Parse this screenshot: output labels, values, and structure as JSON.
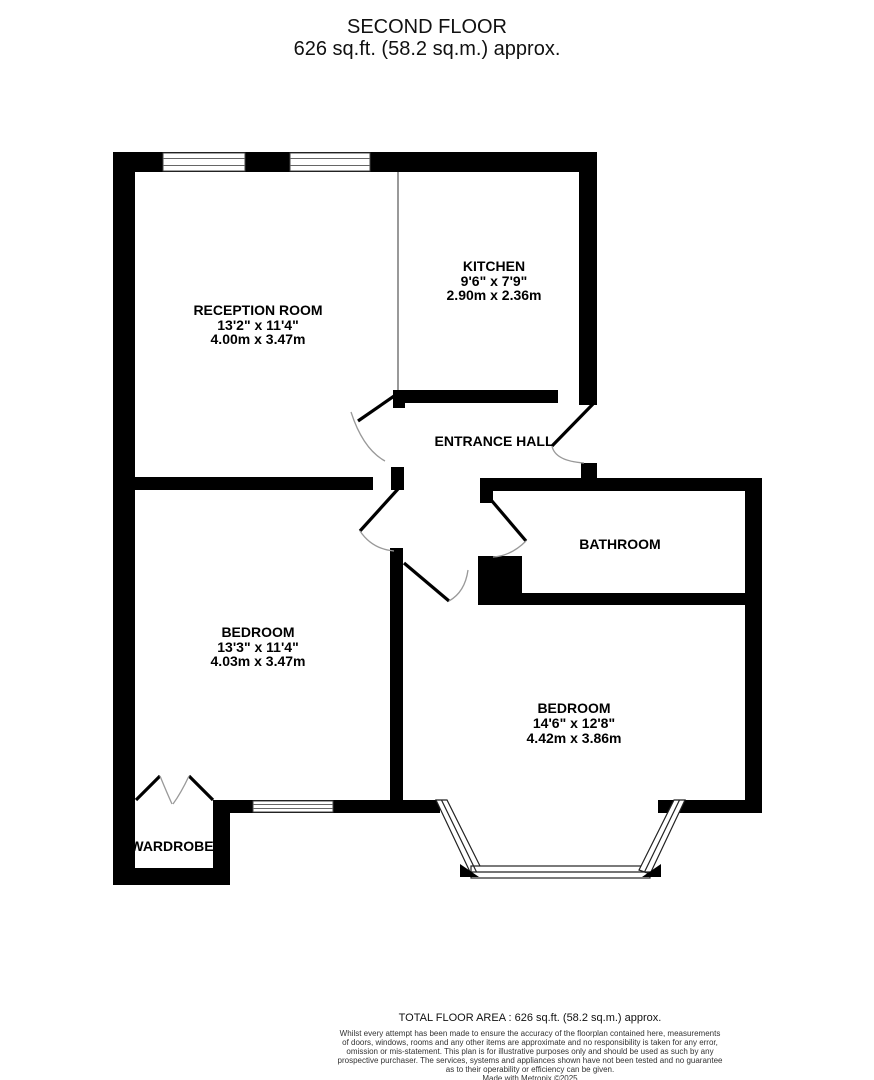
{
  "title": {
    "floor": "SECOND FLOOR",
    "area": "626 sq.ft. (58.2 sq.m.) approx."
  },
  "rooms": {
    "reception": {
      "name": "RECEPTION ROOM",
      "dims_ft": "13'2\" x 11'4\"",
      "dims_m": "4.00m x 3.47m"
    },
    "kitchen": {
      "name": "KITCHEN",
      "dims_ft": "9'6\" x 7'9\"",
      "dims_m": "2.90m x 2.36m"
    },
    "entrance_hall": {
      "name": "ENTRANCE HALL"
    },
    "bathroom": {
      "name": "BATHROOM"
    },
    "bedroom_front": {
      "name": "BEDROOM",
      "dims_ft": "13'3\" x 11'4\"",
      "dims_m": "4.03m x 3.47m"
    },
    "bedroom_rear": {
      "name": "BEDROOM",
      "dims_ft": "14'6\" x 12'8\"",
      "dims_m": "4.42m x 3.86m"
    },
    "wardrobe": {
      "name": "WARDROBE"
    }
  },
  "footer": {
    "total_area": "TOTAL FLOOR AREA : 626 sq.ft. (58.2 sq.m.) approx.",
    "disclaimer_lines": [
      "Whilst every attempt has been made to ensure the accuracy of the floorplan contained here, measurements",
      "of doors, windows, rooms and any other items are approximate and no responsibility is taken for any error,",
      "omission or mis-statement. This plan is for illustrative purposes only and should be used as such by any",
      "prospective purchaser. The services, systems and appliances shown have not been tested and no guarantee",
      "as to their operability or efficiency can be given."
    ],
    "credit": "Made with Metropix ©2025"
  },
  "colors": {
    "wall": "#000000",
    "door_arc": "#999999",
    "window_line": "#666666",
    "text": "#000000"
  }
}
